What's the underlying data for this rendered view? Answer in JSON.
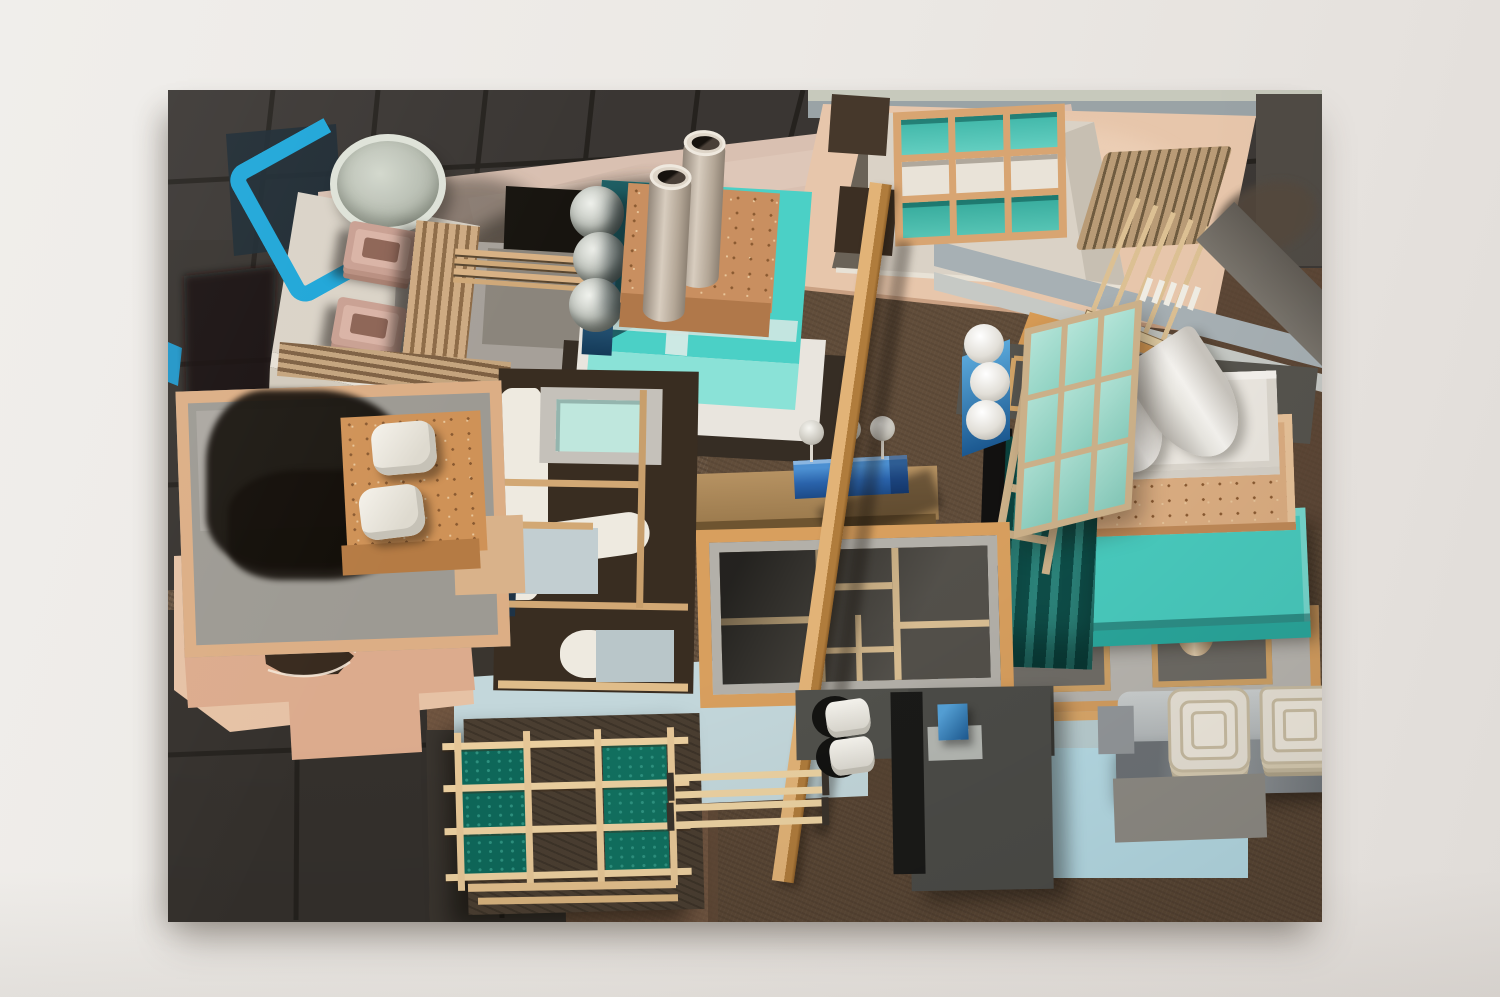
{
  "artwork": {
    "kind": "photograph of a painting hung on a gallery wall",
    "subject": "aerial top-down view of a miniature model city assembled from studio materials: cork blocks, cardboard tubes, painted boxes, wooden sticks, glass panes and foam",
    "visible_text": "none",
    "canvas_rect_px": {
      "left": 168,
      "top": 90,
      "width": 1154,
      "height": 832
    }
  },
  "palette": {
    "wall": "#ece9e5",
    "tile_dark": "#3a3633",
    "tile_grout": "#221f1b",
    "cork_ground": "#66523f",
    "cork_red": "#755741",
    "road_pink": "#d9c0b1",
    "plate_pink": "#e7c6ab",
    "slab_pink": "#e6c2a5",
    "cross_pink": "#dcab8d",
    "cream": "#dad3c7",
    "teal_bright": "#4bd0c6",
    "teal_front": "#8ae2d7",
    "teal_box_right": "#49cbbe",
    "teal_wall_dark": "#0e4d48",
    "glass_teal": "#54c8ba",
    "glass_pale": "#a8ded2",
    "pane_green": "#0e685a",
    "pool_cyan": "#1ea6d8",
    "trough_cobalt": "#2a63ab",
    "stand_blue": "#1b5890",
    "light_blue_ground": "#c3d7db",
    "sage_band": "#c7c9bc",
    "gray_blue_band": "#a7b0b4",
    "wood_stick": "#d7ae74",
    "wood_frame_orange": "#d89f5e",
    "beam_wood": "#c89057",
    "table_wood": "#b69262",
    "cork_block": "#cd9158",
    "slate_panel": "#50504b",
    "floor_dark": "#48453f",
    "near_black": "#191715",
    "white_object": "#f0ede7",
    "appliance_gray": "#aeb3b5"
  },
  "inventory": {
    "cardboard_chimney_tubes": 2,
    "gray_roof_spheres": 3,
    "white_sphere_column": 3,
    "tree_pin_balls": 3,
    "skylight_grid": "3x3, teal top and bottom rows, cream middle row",
    "ground_window_grid": "3x3, green panes in left and right columns, middle open",
    "leaning_glass_panel_grid": "3x3 pale teal",
    "barrel_vaults": 2,
    "pink_stepped_trays": 2,
    "cork_pillows": 2,
    "white_rolls": 2,
    "tray_stacks": 2,
    "platform_legs": 2,
    "long_diagonal_beam": 1
  }
}
